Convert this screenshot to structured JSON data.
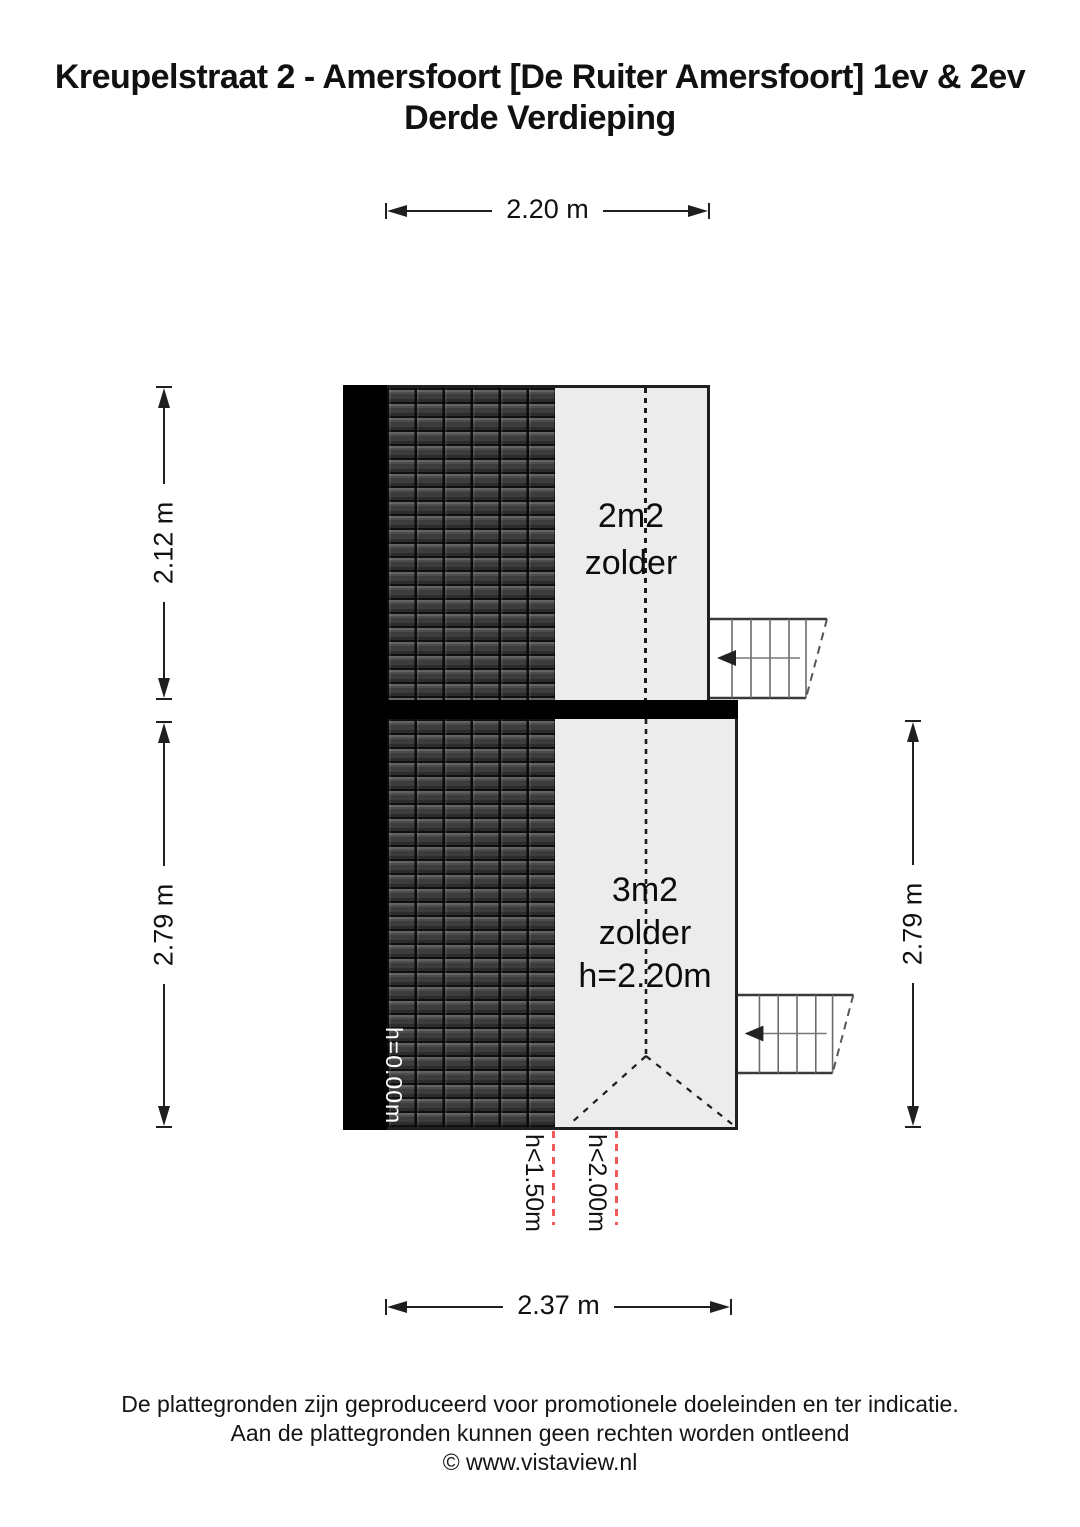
{
  "title": {
    "line1": "Kreupelstraat 2 - Amersfoort [De Ruiter Amersfoort] 1ev & 2ev",
    "line2": "Derde Verdieping"
  },
  "dimensions": {
    "top": "2.20 m",
    "left_upper": "2.12 m",
    "left_lower": "2.79 m",
    "right": "2.79 m",
    "bottom": "2.37 m"
  },
  "rooms": {
    "upper": {
      "area": "2m2",
      "name": "zolder"
    },
    "lower": {
      "area": "3m2",
      "name": "zolder",
      "ceiling_height": "h=2.20m"
    }
  },
  "annotations": {
    "eaves_height": "h=0.00m",
    "height_marker_1": "h<1.50m",
    "height_marker_2": "h<2.00m"
  },
  "footer": {
    "line1": "De plattegronden zijn geproduceerd voor promotionele doeleinden en ter indicatie.",
    "line2": "Aan de plattegronden kunnen geen rechten worden ontleend",
    "line3": "© www.vistaview.nl"
  },
  "colors": {
    "marker_red": "#f25a5a",
    "wall": "#000000",
    "floor": "#ececec",
    "line": "#1f1f1f"
  }
}
